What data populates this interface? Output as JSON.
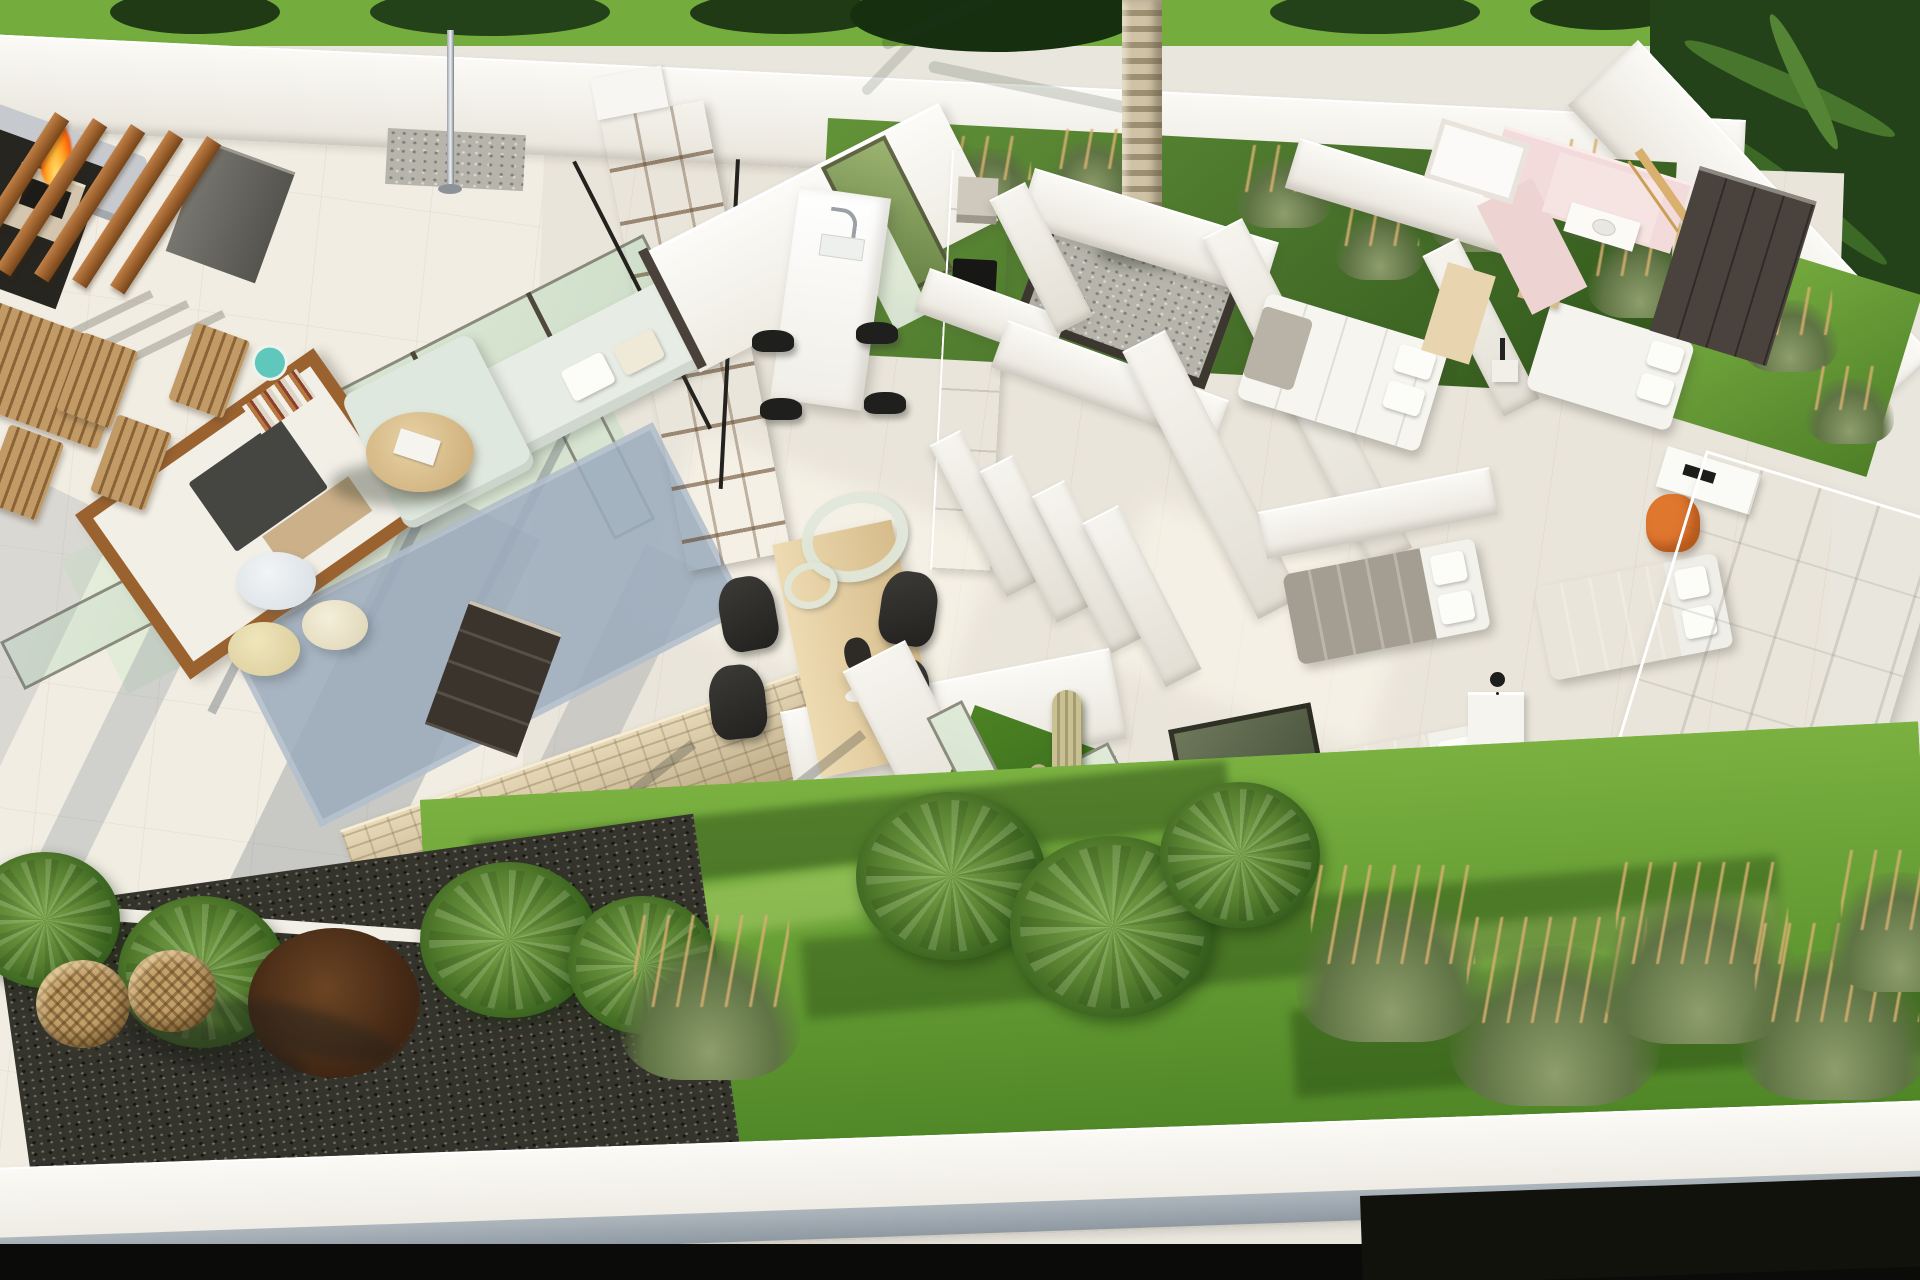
{
  "scene": {
    "kind": "aerial-3d-cutaway-render-of-modern-single-storey-villa",
    "palette": {
      "terrace_floor": "#f1ede3",
      "interior_floor": "#eae5da",
      "perimeter_wall": "#f8f6f1",
      "glass_mint": "#dce8d6",
      "frame_dark": "#4f463c",
      "wood_warm": "#a96f3c",
      "shelf_wood": "#d9b888",
      "sofa_mint": "#e7ece4",
      "rug_blue": "#9dadbe",
      "tv_dark": "#454542",
      "stone_tan": "#cdbb9b",
      "lawn_bright": "#74ad3e",
      "lawn_shadow": "#2e531c",
      "foliage_dark": "#24421a",
      "plant_olive": "#73875a",
      "plume_tan": "#c89f6a",
      "gravel_dark": "#35342c",
      "pebble_gray": "#b6b4ab",
      "fire_orange": "#ff7a12",
      "chair_black": "#2a2a28",
      "bed_gray": "#a49d92",
      "bed_white": "#f6f5f0",
      "pink_wall": "#f3dbdb",
      "wardrobe_dark": "#4a423c",
      "accent_orange": "#e0772f",
      "lantern_tan": "#c2a069"
    },
    "areas": {
      "exterior_top": [
        "boundary-hedge",
        "perimeter-wall",
        "ornamental-grass-bed",
        "palm-tree"
      ],
      "terrace": [
        "timber-slat-screen",
        "fire-pit",
        "outdoor-lounge-sofa",
        "outdoor-dining-chairs",
        "outdoor-shower-pole",
        "glass-sliding-doors"
      ],
      "living_room": [
        "tv-media-wall",
        "bookshelf",
        "l-shaped-sofa",
        "round-coffee-table",
        "poufs",
        "area-rug"
      ],
      "kitchen": [
        "island-with-sink",
        "bar-stools",
        "tall-cabinet-run",
        "induction-hob",
        "palm-lightwell"
      ],
      "dining": [
        "wood-dining-table",
        "black-chairs",
        "decor-rings",
        "stone-feature-wall",
        "dark-sideboard"
      ],
      "bedrooms": [
        "master-bed",
        "guest-bed",
        "twin-beds",
        "nightstands",
        "desk-with-orange-chair",
        "white-wardrobe",
        "dark-wardrobe"
      ],
      "bathroom": [
        "pink-walls",
        "vanity",
        "towel-ladder"
      ],
      "courtyard": [
        "cactus",
        "grass-patch",
        "glass-walls"
      ],
      "garden": [
        "lawn",
        "fan-palm-shrubs",
        "ornamental-grasses",
        "gravel-bed",
        "wicker-lanterns",
        "front-wall"
      ]
    }
  }
}
